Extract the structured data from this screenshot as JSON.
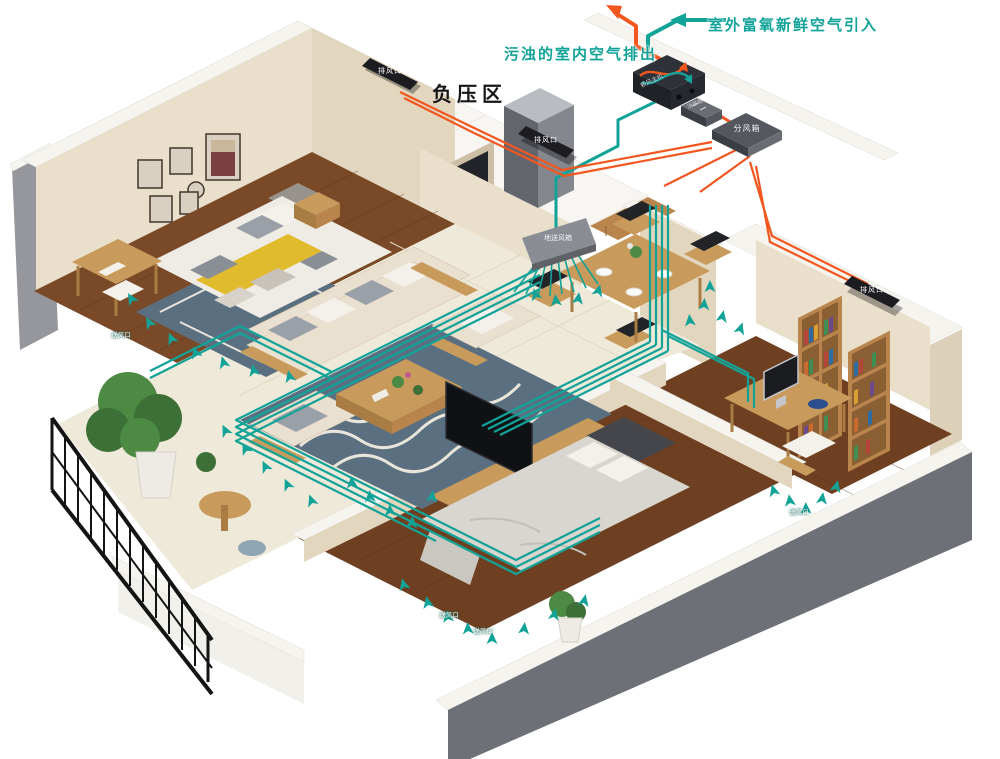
{
  "colors": {
    "teal": "#12a398",
    "orange": "#f2571f"
  },
  "annotations": {
    "fresh_air_intake": "室外富氧新鲜空气引入",
    "indoor_air_exhaust": "污浊的室内空气排出",
    "negative_pressure_zone": "负压区"
  },
  "equipment": {
    "main_unit": "新风主机",
    "silencer": "消音器",
    "air_distribution_box": "分风箱",
    "floor_supply_box": "地送风箱"
  },
  "vents": {
    "exhaust_label": "排风口",
    "supply_label": "送风口",
    "exhaust_count": 3,
    "supply_count": 4
  }
}
